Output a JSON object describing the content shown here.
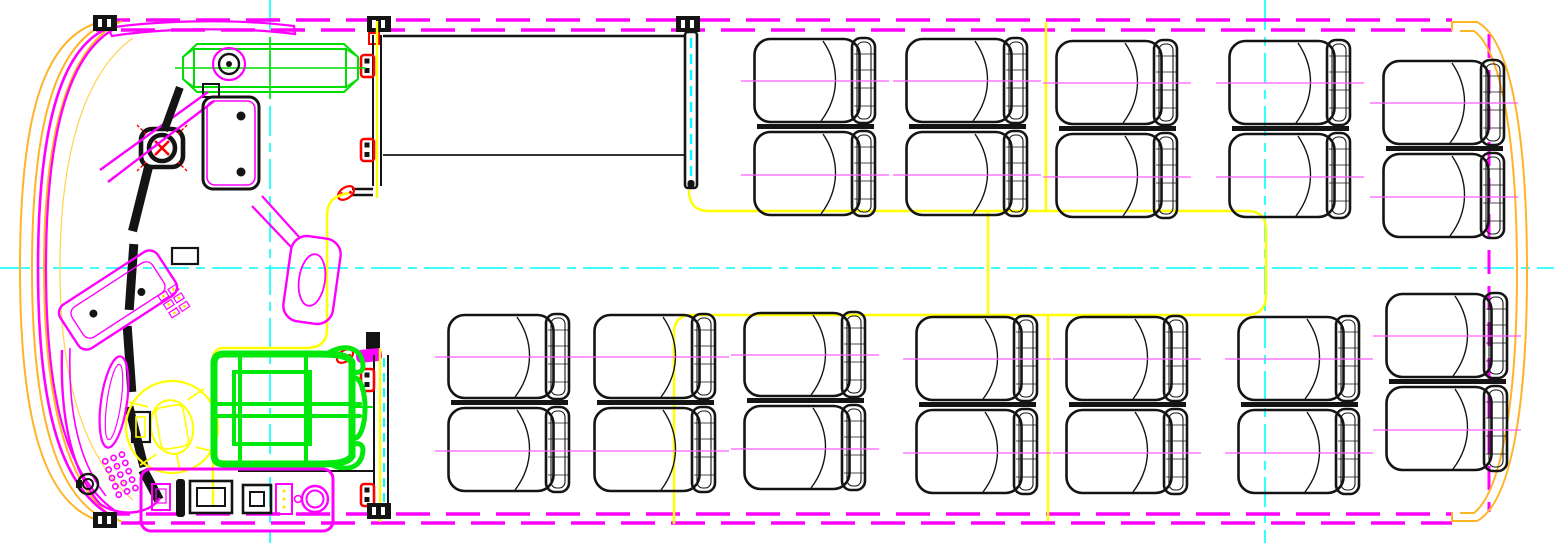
{
  "drawing": {
    "description": "CAD top-view floor plan of a midibus interior: driver cab at front-left drawn in magenta with yellow steering wheel and green driver seat, front entrance door bay with red hinges, passenger saloon with black double seats, yellow gangway boundary lines, cyan dash-dot centerlines and magenta dashed body outline with orange front/rear body curves.",
    "canvas": {
      "width": 1554,
      "height": 543,
      "background": "#FFFFFF"
    },
    "colors": {
      "canvas_bg": "#FFFFFF",
      "body_magenta": "#FF00FF",
      "body_orange": "#FFB428",
      "centerline_cyan": "#00FFFF",
      "gangway_yellow": "#FFFF00",
      "line_black": "#141414",
      "seat_axis": "#FF5CFF",
      "driver_green": "#00E80C",
      "rack_green": "#00DD00",
      "hinge_red": "#FF0000",
      "cab_magenta": "#FF00FF"
    },
    "components": {
      "centerlines": {
        "horizontal_y": 268,
        "vertical_x": [
          270,
          1265
        ]
      },
      "roof_hatch_fan": {
        "shape": "rounded-square with circle and red X"
      },
      "overhead_rack": {
        "color": "green",
        "position": "front top"
      },
      "driver_seat": {
        "color": "green"
      },
      "steering_wheel": {
        "color": "yellow"
      },
      "doors": {
        "front_door_bay": "between two black posts with red hinge brackets",
        "mid_door_leaf": "black column with cyan dashed glass line"
      },
      "hinge_bracket_count": 6
    }
  },
  "seating": {
    "passenger_pair_count": 12,
    "passenger_seat_count": 24,
    "orientation": "all forward facing (backrests at rear/right side)",
    "pairs": [
      {
        "x": 753,
        "y": 36,
        "row": "top"
      },
      {
        "x": 905,
        "y": 36,
        "row": "top"
      },
      {
        "x": 1055,
        "y": 38,
        "row": "top"
      },
      {
        "x": 1228,
        "y": 38,
        "row": "top"
      },
      {
        "x": 1382,
        "y": 58,
        "row": "top-rear"
      },
      {
        "x": 447,
        "y": 312,
        "row": "bottom"
      },
      {
        "x": 593,
        "y": 312,
        "row": "bottom"
      },
      {
        "x": 743,
        "y": 310,
        "row": "bottom"
      },
      {
        "x": 915,
        "y": 314,
        "row": "bottom"
      },
      {
        "x": 1065,
        "y": 314,
        "row": "bottom"
      },
      {
        "x": 1237,
        "y": 314,
        "row": "bottom"
      },
      {
        "x": 1385,
        "y": 291,
        "row": "bottom-rear"
      }
    ]
  }
}
